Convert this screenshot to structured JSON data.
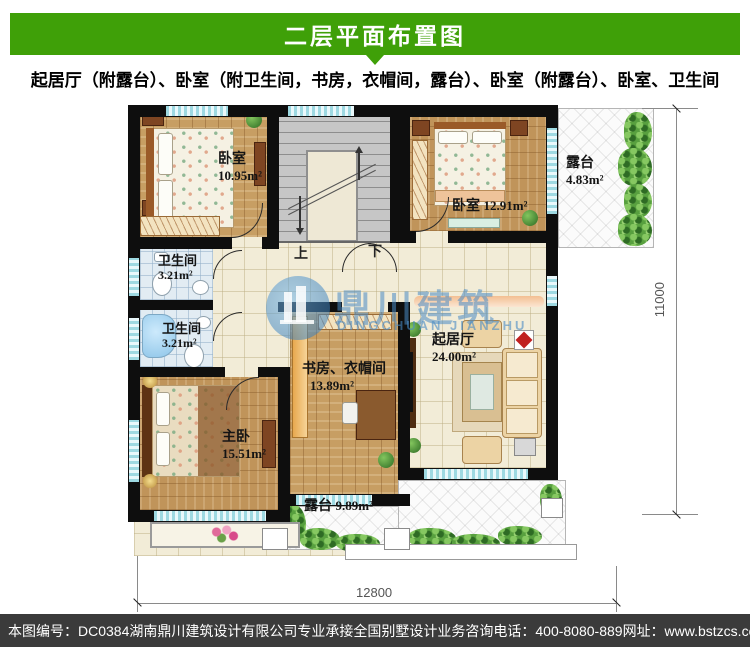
{
  "header": {
    "title": "二层平面布置图"
  },
  "subtitle": "起居厅（附露台）、卧室（附卫生间，书房，衣帽间，露台）、卧室（附露台）、卧室、卫生间",
  "rooms": {
    "bedroom1": {
      "label": "卧室",
      "area": "10.95m²"
    },
    "bedroom2": {
      "label": "卧室",
      "area": "12.91m²"
    },
    "terrace_right": {
      "label": "露台",
      "area": "4.83m²"
    },
    "bath1": {
      "label": "卫生间",
      "area": "3.21m²"
    },
    "bath2": {
      "label": "卫生间",
      "area": "3.21m²"
    },
    "study": {
      "label": "书房、衣帽间",
      "area": "13.89m²"
    },
    "living": {
      "label": "起居厅",
      "area": "24.00m²"
    },
    "master": {
      "label": "主卧",
      "area": "15.51m²"
    },
    "terrace_bottom": {
      "label": "露台",
      "area": "9.89m²"
    }
  },
  "stairs": {
    "up": "上",
    "down": "下"
  },
  "dimensions": {
    "width": "12800",
    "height": "11000"
  },
  "watermark": {
    "cn": "鼎川建筑",
    "en": "DINGCHUAN JIANZHU"
  },
  "footer": {
    "serial": "本图编号：DC0384",
    "company": "湖南鼎川建筑设计有限公司专业承接全国别墅设计业务",
    "phone": "咨询电话：400-8080-889",
    "site": "网址：www.bstzcs.com"
  },
  "colors": {
    "accent_green": "#3fa008",
    "footer_bg": "#3b3b3b",
    "watermark_blue": "#488ac4"
  }
}
